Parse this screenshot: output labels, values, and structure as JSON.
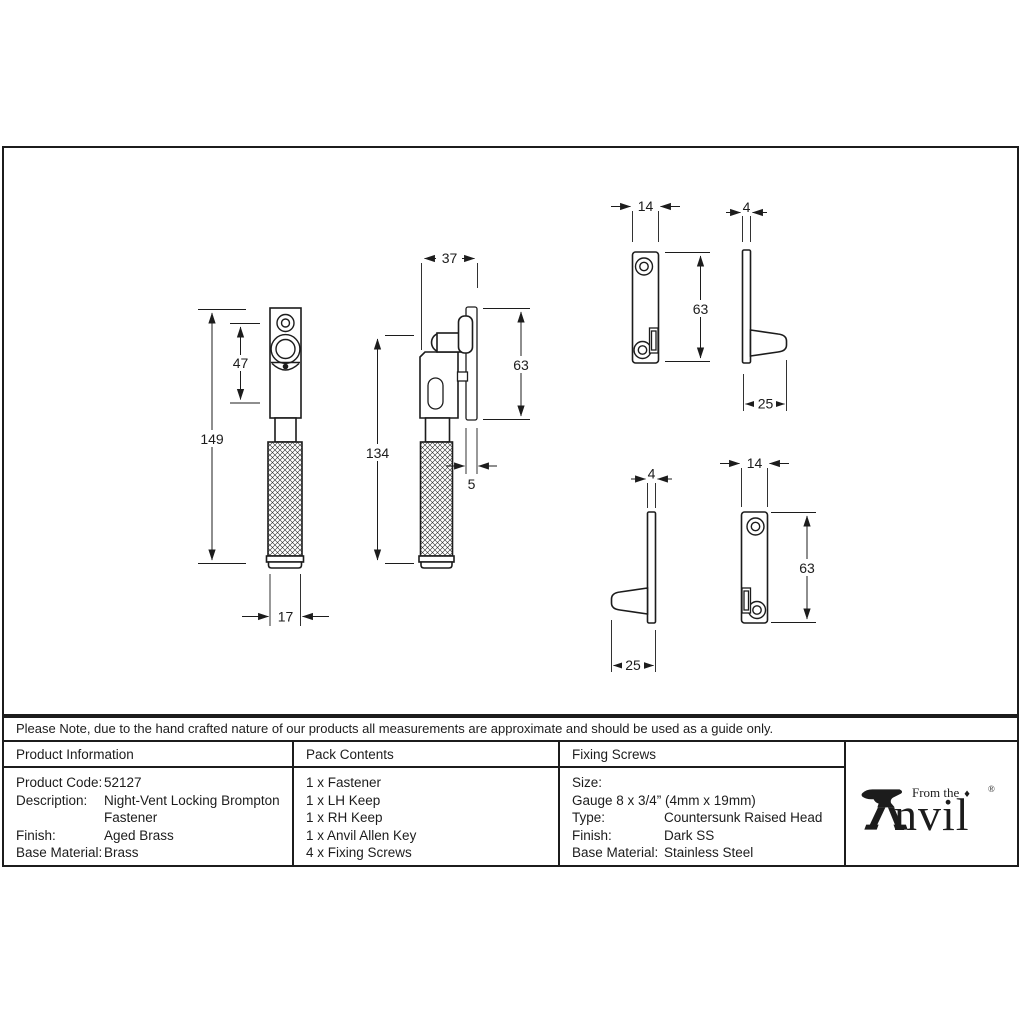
{
  "colors": {
    "ink": "#1c1c1c",
    "background": "#ffffff"
  },
  "note_text": "Please Note, due to the hand crafted nature of our products all measurements are approximate and should be used as a guide only.",
  "product_information": {
    "header": "Product Information",
    "labels": [
      "Product Code:",
      "Description:",
      "",
      "Finish:",
      "Base Material:"
    ],
    "values": [
      "52127",
      "Night-Vent Locking Brompton",
      "Fastener",
      "Aged Brass",
      "Brass"
    ]
  },
  "pack_contents": {
    "header": "Pack Contents",
    "items": [
      "1 x Fastener",
      "1 x LH Keep",
      "1 x RH Keep",
      "1 x Anvil Allen Key",
      "4 x Fixing Screws"
    ]
  },
  "fixing_screws": {
    "header": "Fixing Screws",
    "labels": [
      "Size:",
      "Type:",
      "Finish:",
      "Base Material:"
    ],
    "values": [
      "Gauge 8 x 3/4” (4mm x 19mm)",
      "Countersunk Raised Head",
      "Dark SS",
      "Stainless Steel"
    ]
  },
  "logo": {
    "prefix": "From the",
    "diamond": "♦",
    "word_rest": "nvil",
    "registered": "®"
  },
  "dimensions": {
    "fastener_front": {
      "height": "149",
      "plate_height": "47",
      "width": "17"
    },
    "fastener_side": {
      "depth": "37",
      "height": "134",
      "keep_height": "63",
      "keep_thickness": "5"
    },
    "keep_right_front": {
      "width": "14",
      "height": "63"
    },
    "keep_right_side": {
      "thickness": "4",
      "projection": "25"
    },
    "keep_left_side": {
      "thickness": "4",
      "projection": "25"
    },
    "keep_left_front": {
      "width": "14",
      "height": "63"
    }
  }
}
